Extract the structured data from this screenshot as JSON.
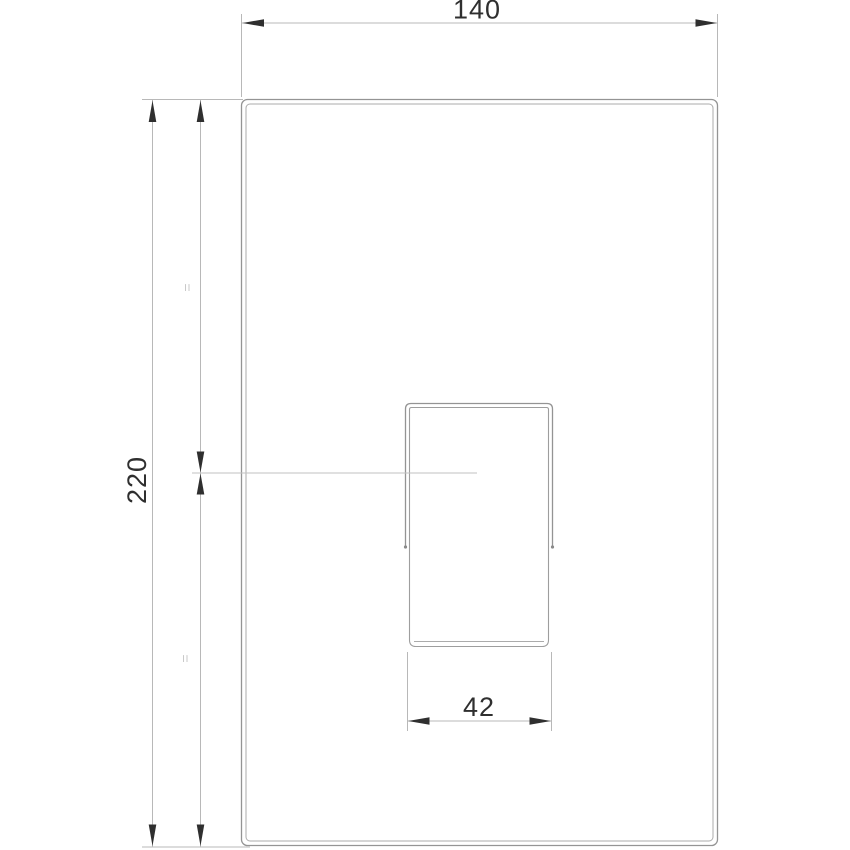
{
  "drawing": {
    "type": "technical-dimension-drawing",
    "subject": "rectangular-trim-plate-with-lever-handle",
    "dimensions": {
      "top_width_label": "140",
      "left_height_label": "220",
      "handle_width_label": "42"
    },
    "symbols": {
      "equal_mark_top": "=",
      "equal_mark_bottom": "="
    },
    "colors": {
      "background": "#ffffff",
      "outline": "#949494",
      "outline_light": "#ababab",
      "dimension_line": "#b8b8b8",
      "centerline": "#c2c2c2",
      "arrow_and_text": "#2f2f2f",
      "equal_mark": "#c9c9c9"
    }
  }
}
